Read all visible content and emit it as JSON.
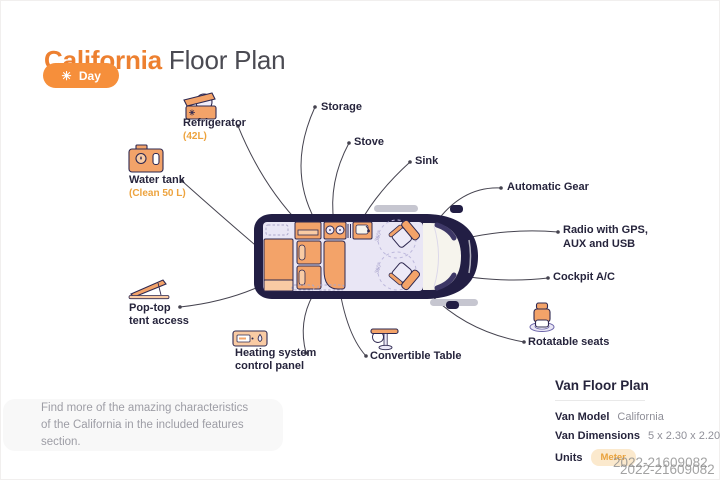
{
  "title": {
    "highlight": "California",
    "rest": "Floor Plan"
  },
  "toolbar": {
    "day_label": "Day"
  },
  "icons": {
    "sun": "☀"
  },
  "callouts": {
    "refrigerator": {
      "label": "Refrigerator",
      "sub": "(42L)"
    },
    "storage": {
      "label": "Storage"
    },
    "stove": {
      "label": "Stove"
    },
    "sink": {
      "label": "Sink"
    },
    "water_tank": {
      "label": "Water tank",
      "sub": "(Clean 50 L)"
    },
    "automatic_gear": {
      "label": "Automatic Gear"
    },
    "radio": {
      "line1": "Radio with GPS,",
      "line2": "AUX and USB"
    },
    "cockpit_ac": {
      "label": "Cockpit A/C"
    },
    "pop_top": {
      "line1": "Pop-top",
      "line2": "tent access"
    },
    "heating": {
      "line1": "Heating system",
      "line2": "control panel"
    },
    "convertible_table": {
      "label": "Convertible Table"
    },
    "rotatable_seats": {
      "label": "Rotatable seats"
    }
  },
  "diagram": {
    "rotation_label": "360°"
  },
  "note": {
    "line1": "Find more of the amazing characteristics",
    "line2": "of the California in the included features section."
  },
  "details": {
    "heading": "Van Floor Plan",
    "rows": [
      {
        "label": "Van Model",
        "value": "California"
      },
      {
        "label": "Van Dimensions",
        "value": "5 x 2.30 x 2.20m"
      },
      {
        "label": "Units",
        "value": "Meter"
      }
    ]
  },
  "watermark": "2022-21609082",
  "colors": {
    "accent_orange": "#ed8030",
    "sub_orange": "#eda33e",
    "van_body": "#221e44",
    "interior": "#e9e6f5",
    "furniture": "#f3a369",
    "day_pill": "#f68f3b",
    "badge_bg": "#fbe9cd"
  }
}
